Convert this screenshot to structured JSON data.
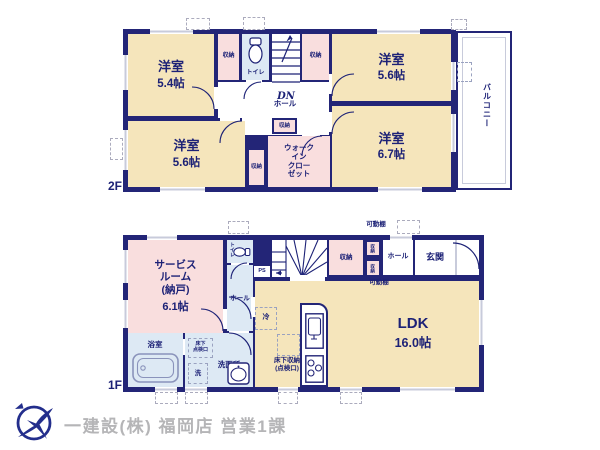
{
  "shared": {
    "storage_label": "収納",
    "hall_label": "ホール",
    "toilet_label": "トイレ",
    "western_room_label": "洋室",
    "movable_shelf_label": "可動棚"
  },
  "floor2": {
    "floor_label": "2F",
    "bedroom1_size": "5.4帖",
    "bedroom2_size": "5.6帖",
    "bedroom3_size": "5.6帖",
    "bedroom4_size": "6.7帖",
    "walk_in_closet_label": "ウォーク\nイン\nクロー\nゼット",
    "stairs_label": "DN",
    "balcony_label": "バルコニー"
  },
  "floor1": {
    "floor_label": "1F",
    "service_room_name": "サービス\nルーム\n(納戸)",
    "service_room_size": "6.1帖",
    "ldk_name": "LDK",
    "ldk_size": "16.0帖",
    "bath_label": "浴室",
    "washroom_label": "洗面所",
    "laundry_label": "洗",
    "underfloor_access_label": "床下\n点検口",
    "underfloor_storage_label": "床下収納\n(点検口)",
    "fridge_label": "冷",
    "ps_label": "PS",
    "stairs_label": "UP",
    "entrance_label": "玄関"
  },
  "footer": {
    "company": "一建設(株) 福岡店 営業1課"
  },
  "colors": {
    "wall": "#232577",
    "room_fill": "#f5e5bb",
    "closet_fill": "#f9dede",
    "wet_fill": "#dde9f4",
    "window_gray": "#c8cbdb",
    "text_navy": "#1c2176",
    "logo_navy": "#232e8c",
    "footer_gray": "#b5b5b7"
  }
}
